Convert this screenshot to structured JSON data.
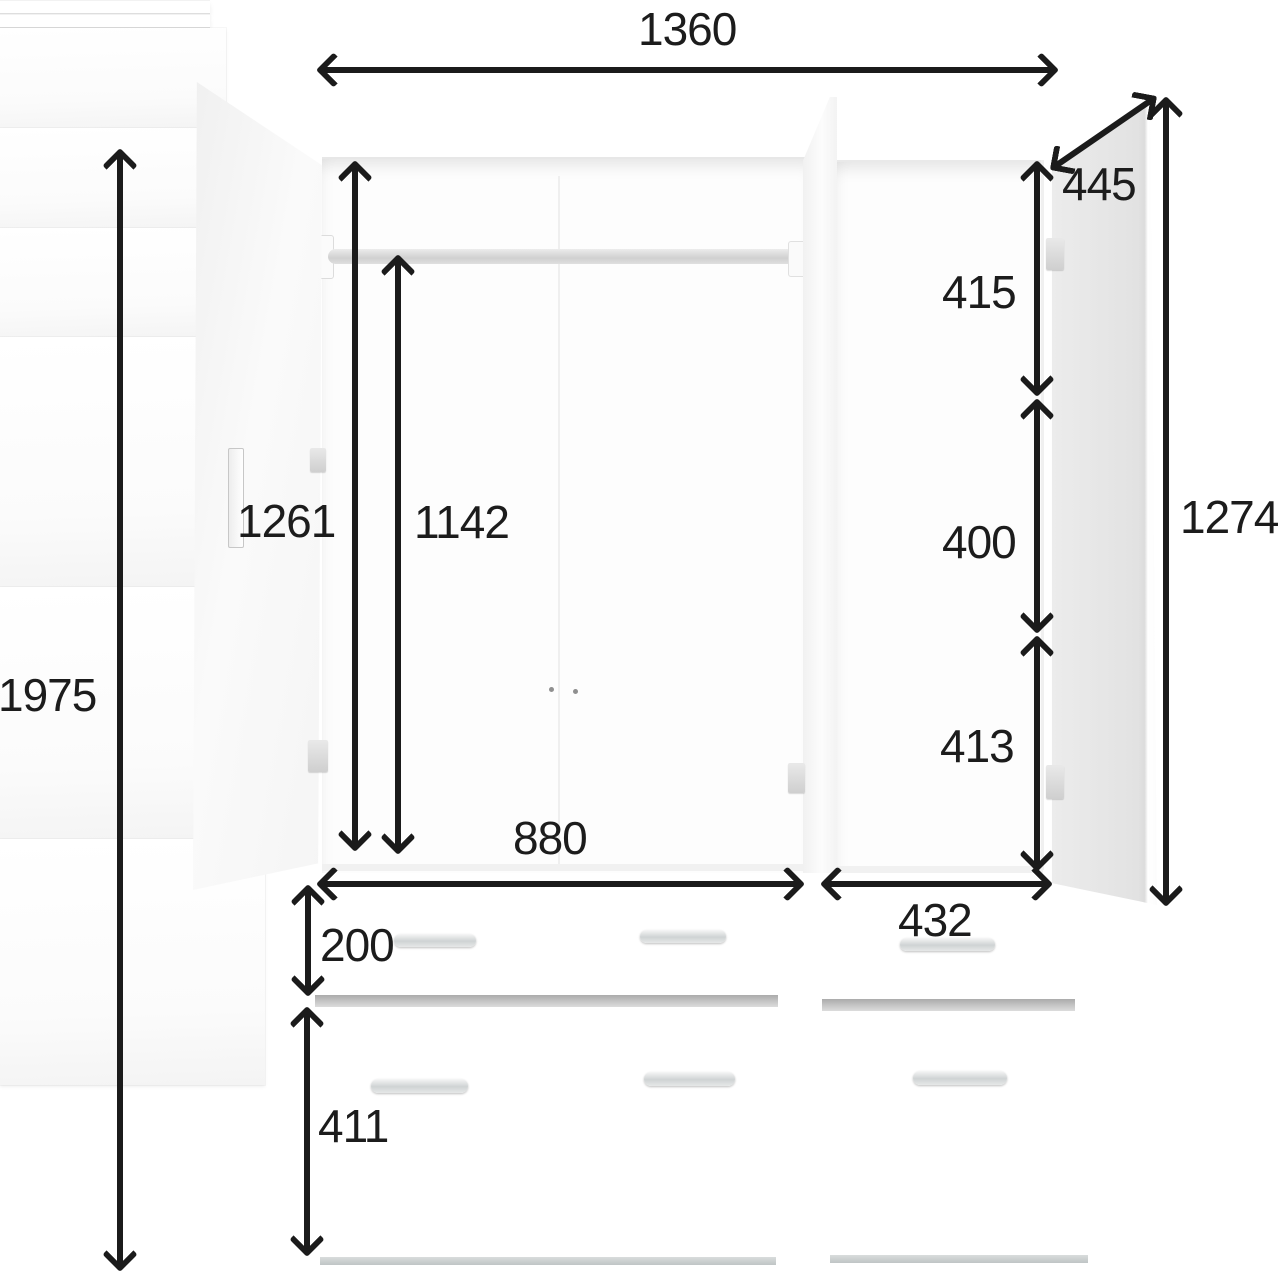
{
  "diagram_title": "Wardrobe dimension diagram",
  "dimensions": {
    "width_overall": "1360",
    "height_overall": "1975",
    "interior_height": "1261",
    "rail_height": "1142",
    "door_depth": "445",
    "compartment_top": "415",
    "compartment_middle": "400",
    "compartment_bottom": "413",
    "right_door_height": "1274",
    "width_main_section": "880",
    "width_right_section": "432",
    "drawer_height": "200",
    "lower_door_height": "411"
  },
  "colors": {
    "arrow": "#1b1b1b",
    "background": "#ffffff",
    "door_shade": "#e4e4e4",
    "handle_silver": "#cfd3d4"
  }
}
